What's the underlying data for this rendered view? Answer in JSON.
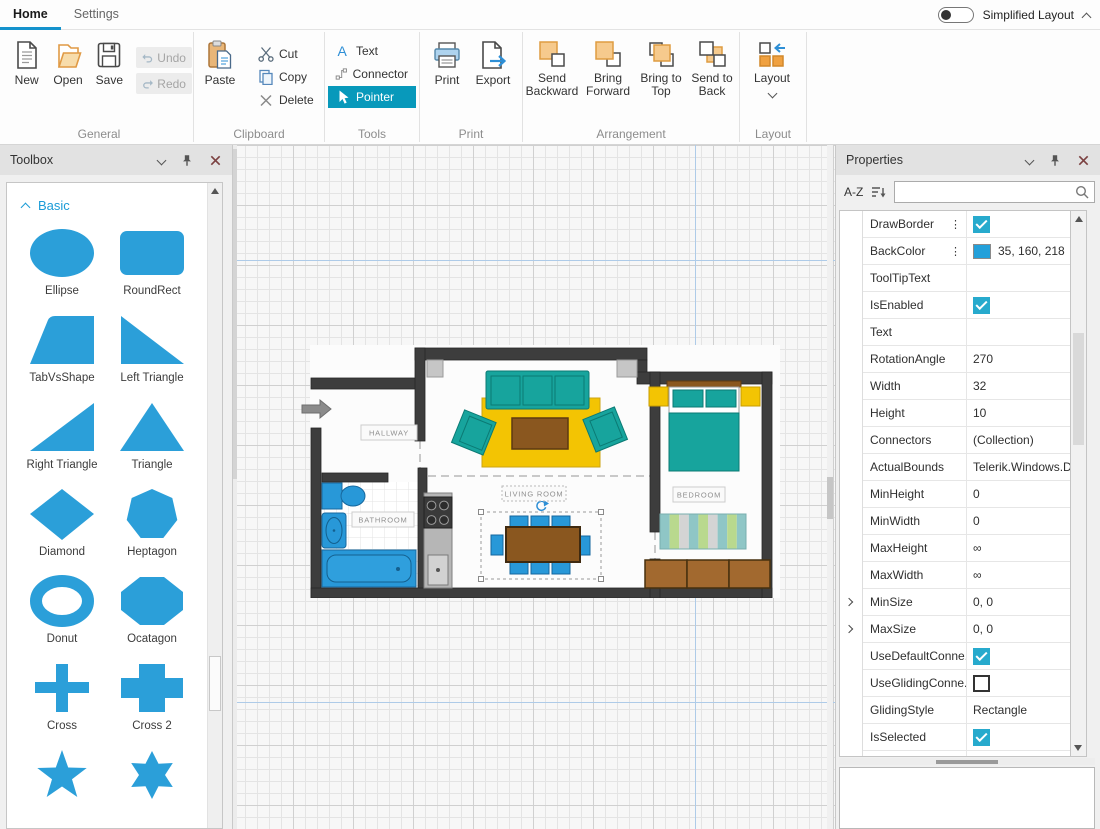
{
  "colors": {
    "accent_blue": "#1492cc",
    "shape_blue": "#2b9fd9",
    "checkbox_teal": "#27aacd",
    "back_color_swatch": "#23A0DA",
    "pointer_selected_bg": "#0899bb"
  },
  "tabbar": {
    "tabs": [
      {
        "label": "Home",
        "active": true
      },
      {
        "label": "Settings",
        "active": false
      }
    ],
    "toggle_label": "Simplified Layout"
  },
  "ribbon": {
    "general": {
      "label": "General",
      "new": "New",
      "open": "Open",
      "save": "Save",
      "undo": "Undo",
      "redo": "Redo"
    },
    "clipboard": {
      "label": "Clipboard",
      "paste": "Paste",
      "cut": "Cut",
      "copy": "Copy",
      "delete": "Delete"
    },
    "tools": {
      "label": "Tools",
      "text": "Text",
      "connector": "Connector",
      "pointer": "Pointer"
    },
    "print": {
      "label": "Print",
      "print": "Print",
      "export": "Export"
    },
    "arrangement": {
      "label": "Arrangement",
      "send_backward": "Send Backward",
      "bring_forward": "Bring Forward",
      "bring_to_top": "Bring to Top",
      "send_to_back": "Send to Back"
    },
    "layout": {
      "label": "Layout",
      "button": "Layout"
    }
  },
  "toolbox": {
    "title": "Toolbox",
    "section": "Basic",
    "shapes": [
      {
        "type": "ellipse",
        "label": "Ellipse"
      },
      {
        "type": "roundrect",
        "label": "RoundRect"
      },
      {
        "type": "tabvsshape",
        "label": "TabVsShape"
      },
      {
        "type": "lefttriangle",
        "label": "Left Triangle"
      },
      {
        "type": "righttriangle",
        "label": "Right Triangle"
      },
      {
        "type": "triangle",
        "label": "Triangle"
      },
      {
        "type": "diamond",
        "label": "Diamond"
      },
      {
        "type": "heptagon",
        "label": "Heptagon"
      },
      {
        "type": "donut",
        "label": "Donut"
      },
      {
        "type": "octagon",
        "label": "Ocatagon"
      },
      {
        "type": "cross",
        "label": "Cross"
      },
      {
        "type": "cross2",
        "label": "Cross 2"
      },
      {
        "type": "star5",
        "label": ""
      },
      {
        "type": "star6",
        "label": ""
      }
    ]
  },
  "canvas": {
    "room_labels": {
      "hallway": "HALLWAY",
      "bathroom": "BATHROOM",
      "living": "LIVING ROOM",
      "bedroom": "BEDROOM"
    }
  },
  "properties": {
    "title": "Properties",
    "sort_button": "A-Z",
    "search_value": "",
    "rows": [
      {
        "name": "DrawBorder",
        "type": "check",
        "checked": true,
        "menu": true
      },
      {
        "name": "BackColor",
        "type": "color",
        "value": "35, 160, 218",
        "swatch": "#23A0DA",
        "menu": true
      },
      {
        "name": "ToolTipText",
        "type": "text",
        "value": ""
      },
      {
        "name": "IsEnabled",
        "type": "check",
        "checked": true
      },
      {
        "name": "Text",
        "type": "text",
        "value": ""
      },
      {
        "name": "RotationAngle",
        "type": "text",
        "value": "270"
      },
      {
        "name": "Width",
        "type": "text",
        "value": "32"
      },
      {
        "name": "Height",
        "type": "text",
        "value": "10"
      },
      {
        "name": "Connectors",
        "type": "text",
        "value": "(Collection)"
      },
      {
        "name": "ActualBounds",
        "type": "text",
        "value": "Telerik.Windows.Di"
      },
      {
        "name": "MinHeight",
        "type": "text",
        "value": "0"
      },
      {
        "name": "MinWidth",
        "type": "text",
        "value": "0"
      },
      {
        "name": "MaxHeight",
        "type": "text",
        "value": "∞"
      },
      {
        "name": "MaxWidth",
        "type": "text",
        "value": "∞"
      },
      {
        "name": "MinSize",
        "type": "text",
        "value": "0, 0",
        "expander": true
      },
      {
        "name": "MaxSize",
        "type": "text",
        "value": "0, 0",
        "expander": true
      },
      {
        "name": "UseDefaultConne...",
        "type": "check",
        "checked": true
      },
      {
        "name": "UseGlidingConne...",
        "type": "check",
        "checked": false
      },
      {
        "name": "GlidingStyle",
        "type": "text",
        "value": "Rectangle"
      },
      {
        "name": "IsSelected",
        "type": "check",
        "checked": true
      },
      {
        "name": "",
        "type": "check",
        "checked": false
      }
    ]
  }
}
